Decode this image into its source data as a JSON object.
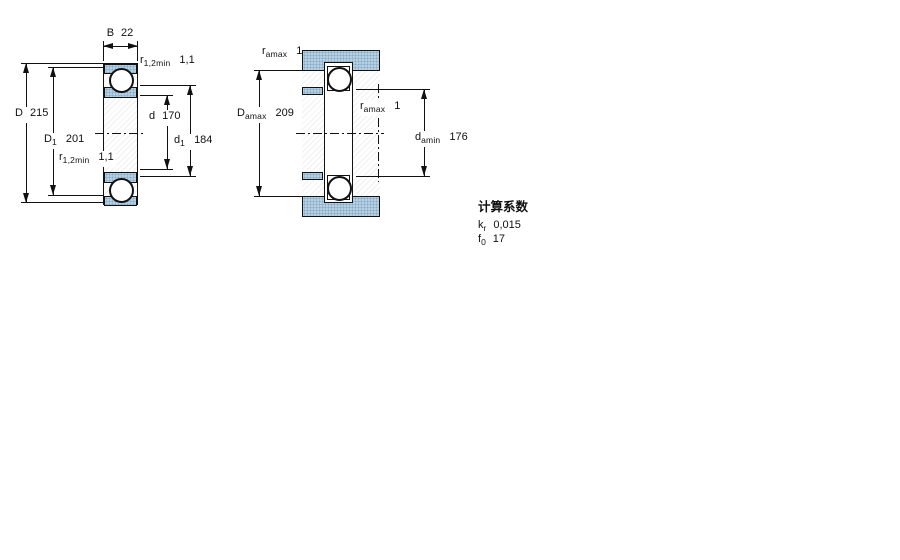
{
  "figure_left": {
    "labels": {
      "width": {
        "main": "B",
        "value": "22"
      },
      "r_top": {
        "main": "r",
        "sub": "1,2min",
        "value": "1,1"
      },
      "outer_diameter": {
        "main": "D",
        "value": "215"
      },
      "bore_diameter": {
        "main": "d",
        "value": "170"
      },
      "shoulder_outer": {
        "main": "D",
        "sub": "1",
        "value": "201"
      },
      "shoulder_inner": {
        "main": "d",
        "sub": "1",
        "value": "184"
      },
      "r_bottom": {
        "main": "r",
        "sub": "1,2min",
        "value": "1,1"
      }
    }
  },
  "figure_right": {
    "labels": {
      "fillet_top": {
        "main": "r",
        "sub": "amax",
        "value": "1"
      },
      "housing_abutment": {
        "main": "D",
        "sub": "amax",
        "value": "209"
      },
      "fillet_mid": {
        "main": "r",
        "sub": "amax",
        "value": "1"
      },
      "shaft_abutment": {
        "main": "d",
        "sub": "amin",
        "value": "176"
      }
    }
  },
  "calculation_factors": {
    "title": "计算系数",
    "rows": [
      {
        "main": "k",
        "sub": "r",
        "value": "0,015"
      },
      {
        "main": "f",
        "sub": "0",
        "value": "17"
      }
    ]
  },
  "colors": {
    "fill_blue": "#b6d0e2",
    "dot_blue": "#85aac8",
    "line": "#111111"
  }
}
